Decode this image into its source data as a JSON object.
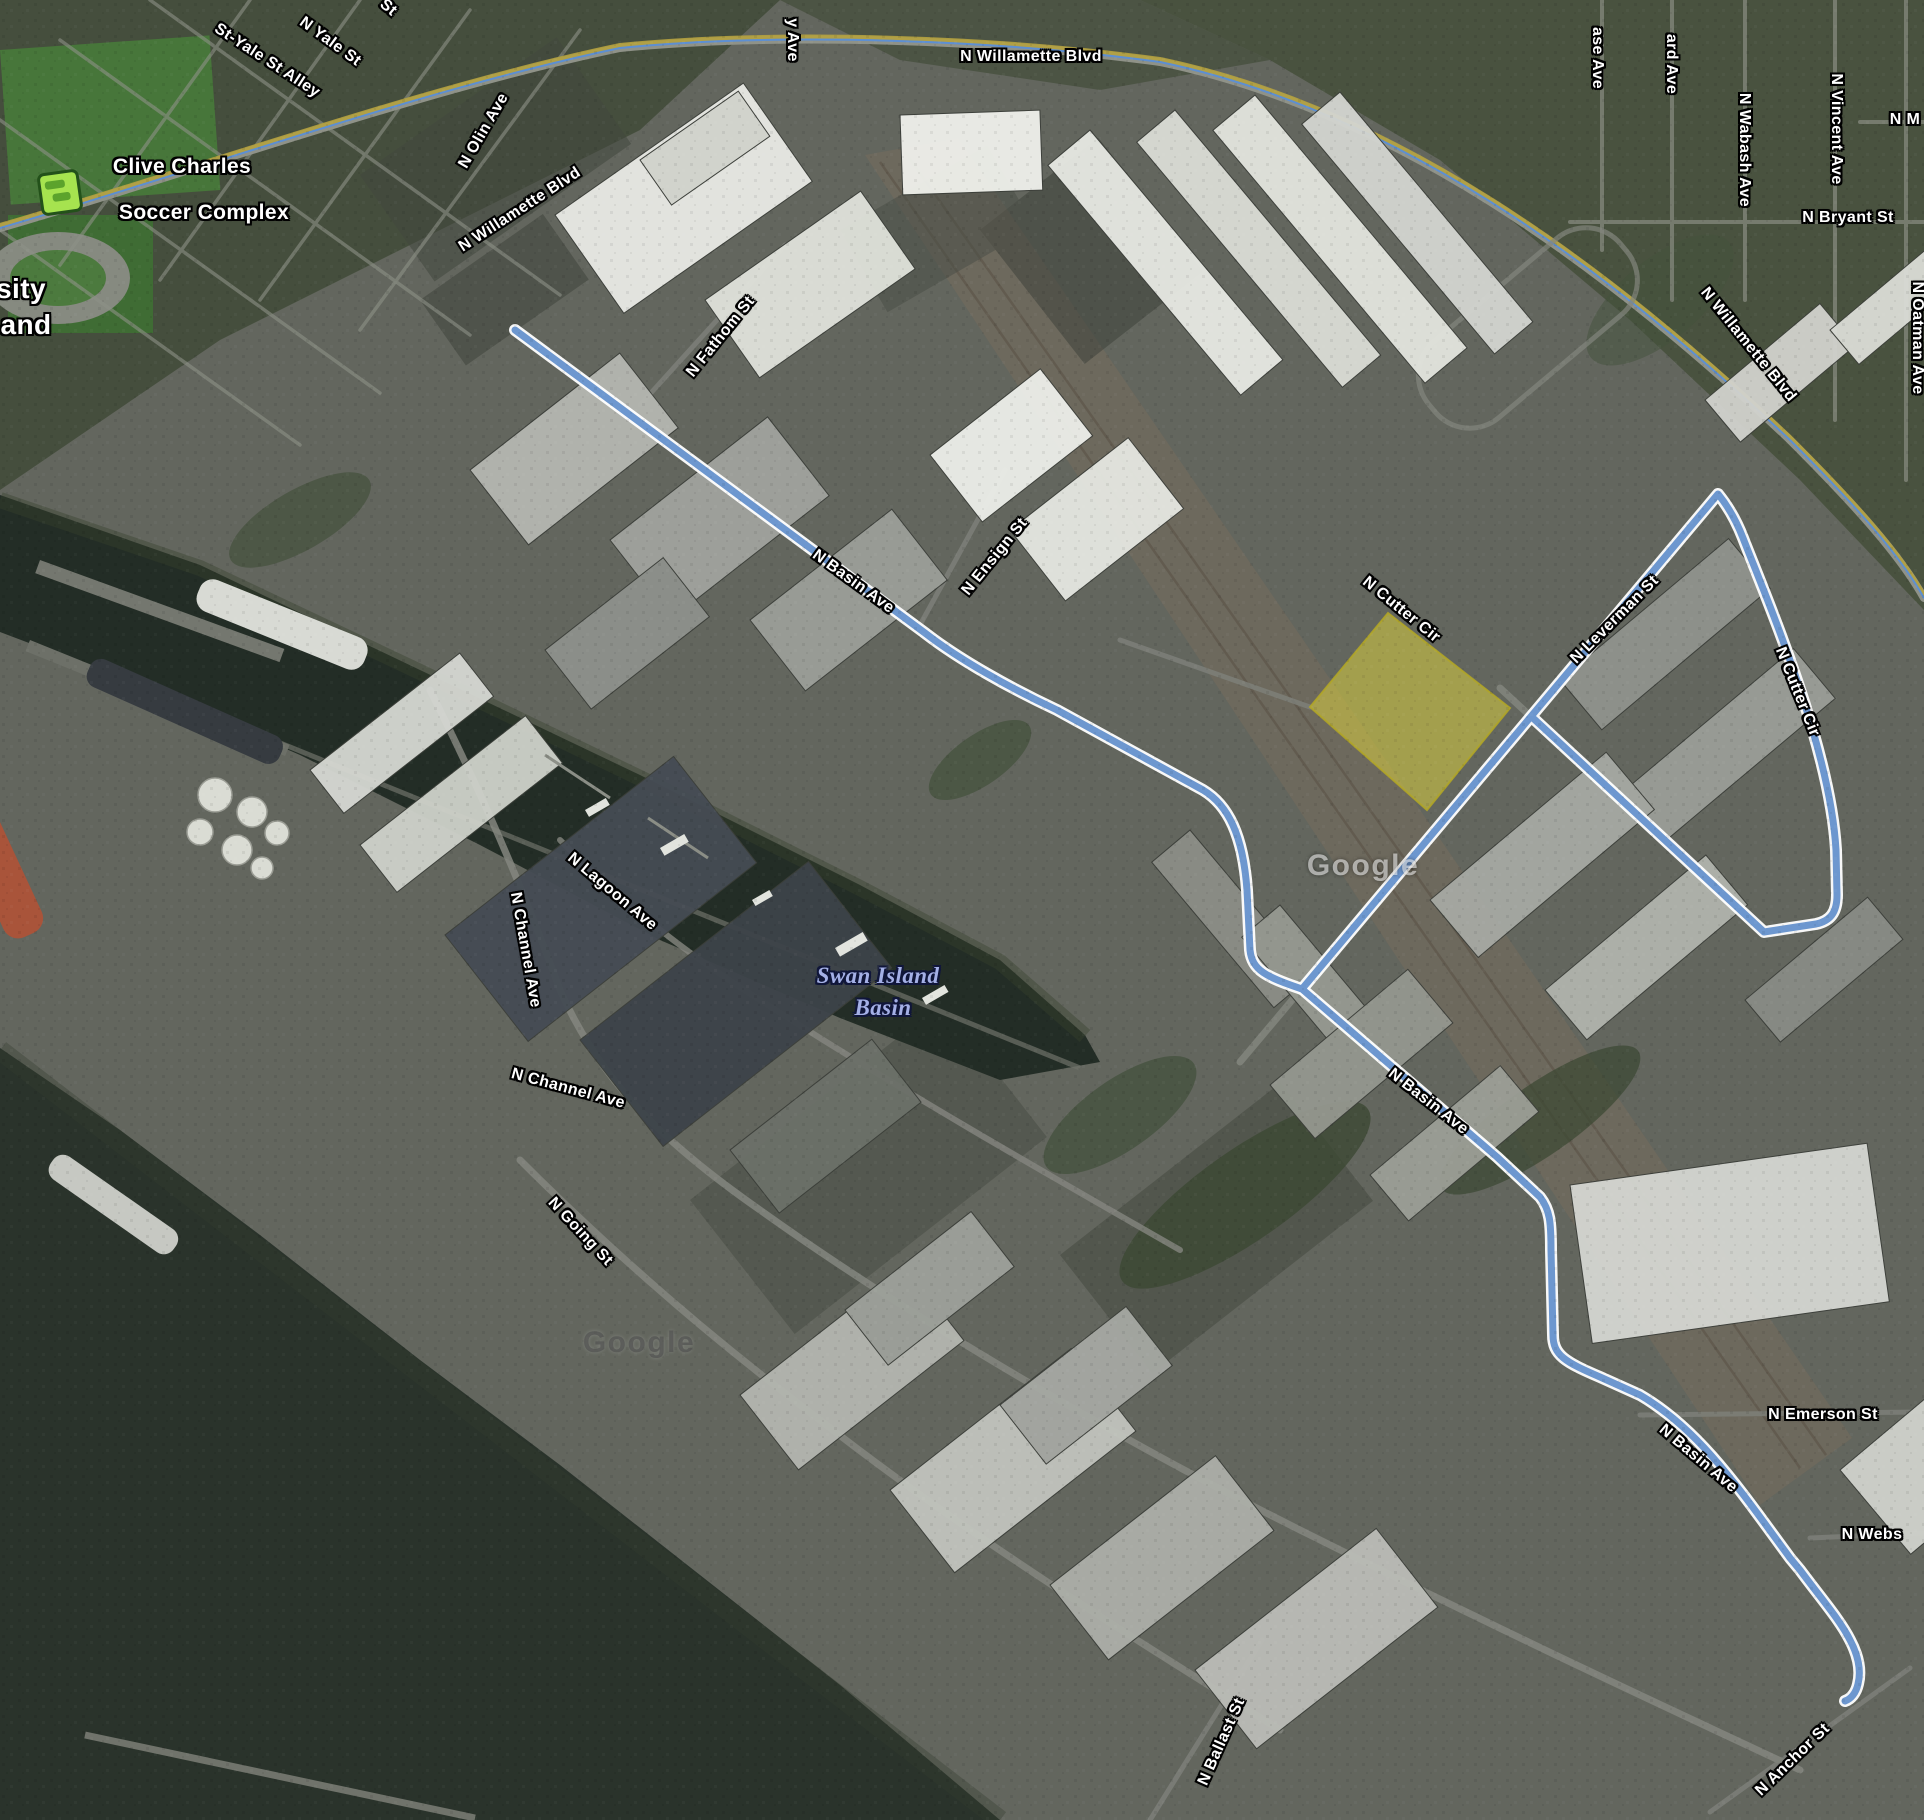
{
  "map_type": "satellite",
  "watermark": "Google",
  "poi": {
    "soccer_complex_line1": "Clive Charles",
    "soccer_complex_line2": "Soccer Complex",
    "icon": "sports-field-icon"
  },
  "water_feature": {
    "line1": "Swan Island",
    "line2": "Basin"
  },
  "area_fragments": {
    "frag1": "sity",
    "frag2": "and"
  },
  "colors": {
    "route": "#6d97cf",
    "route_casing": "#ffffff",
    "parcel_fill": "#d9cd3f",
    "parcel_stroke": "#b3a726",
    "water": "#232d26",
    "water_label": "#a4b0e6"
  },
  "labels": [
    {
      "text": "Clive Charles"
    },
    {
      "text": "Soccer Complex"
    },
    {
      "text": "sity"
    },
    {
      "text": "and"
    },
    {
      "text": "St-Yale St Alley"
    },
    {
      "text": "N Yale St"
    },
    {
      "text": "St"
    },
    {
      "text": "N Olin Ave"
    },
    {
      "text": "N Willamette Blvd"
    },
    {
      "text": "N Willamette Blvd"
    },
    {
      "text": "y Ave"
    },
    {
      "text": "ase Ave"
    },
    {
      "text": "ard Ave"
    },
    {
      "text": "N Wabash Ave"
    },
    {
      "text": "N Vincent Ave"
    },
    {
      "text": "N M"
    },
    {
      "text": "N Bryant St"
    },
    {
      "text": "N Oatman Ave"
    },
    {
      "text": "N Willamette Blvd"
    },
    {
      "text": "N Fathom St"
    },
    {
      "text": "N Basin Ave"
    },
    {
      "text": "N Ensign St"
    },
    {
      "text": "N Cutter Cir"
    },
    {
      "text": "N Leverman St"
    },
    {
      "text": "N Cutter Cir"
    },
    {
      "text": "Swan Island"
    },
    {
      "text": "Basin"
    },
    {
      "text": "N Channel Ave"
    },
    {
      "text": "N Lagoon Ave"
    },
    {
      "text": "N Channel Ave"
    },
    {
      "text": "N Going St"
    },
    {
      "text": "N Basin Ave"
    },
    {
      "text": "N Emerson St"
    },
    {
      "text": "N Basin Ave"
    },
    {
      "text": "N Webs"
    },
    {
      "text": "N Ballast St"
    },
    {
      "text": "N Anchor St"
    },
    {
      "text": "Google"
    },
    {
      "text": "Google"
    }
  ]
}
